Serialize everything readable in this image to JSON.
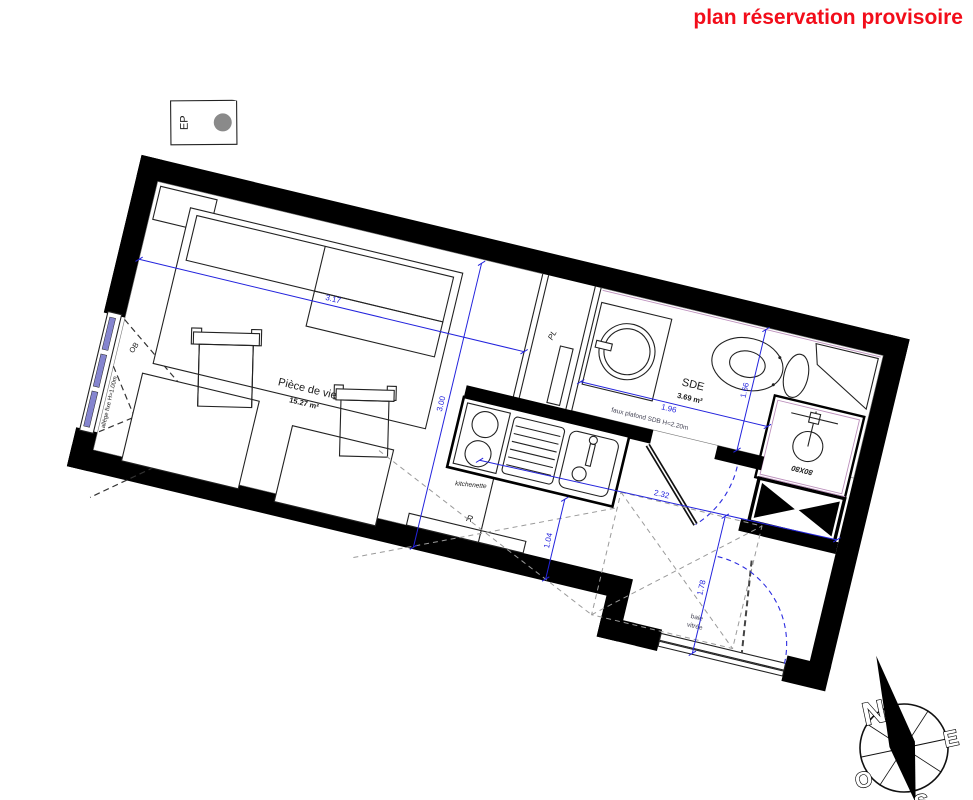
{
  "title": "plan réservation provisoire",
  "plan": {
    "living": {
      "name": "Pièce de vie",
      "area": "15.27 m²"
    },
    "sde": {
      "name": "SDE",
      "area": "3.69 m²",
      "ceiling_note": "faux plafond SDB H=2.20m"
    },
    "closet_label": "PL",
    "kitchen_label": "kitchenette",
    "radiator_label": "R",
    "window_label": "F",
    "window_type_label": "OB",
    "rainpipe_label": "EP",
    "shower_size_label": "80X80",
    "glazed_sill_label": "Allège vitrée",
    "fixed_sill_note": "allège fixe H=1.00m",
    "bay_window_label_1": "baie",
    "bay_window_label_2": "vitrée",
    "dims": {
      "bed": "3.17",
      "living_depth": "3.00",
      "hall": "1.04",
      "sde_width": "1.96",
      "sde_depth": "1.66",
      "entry_width": "2.32",
      "entry_depth": "1.78"
    }
  },
  "compass": {
    "n": "N",
    "e": "E",
    "s": "S",
    "o": "O"
  },
  "colors": {
    "accent_red": "#f20d1a",
    "dim_blue": "#2323dd",
    "sill_gray": "#9a9a9a"
  }
}
